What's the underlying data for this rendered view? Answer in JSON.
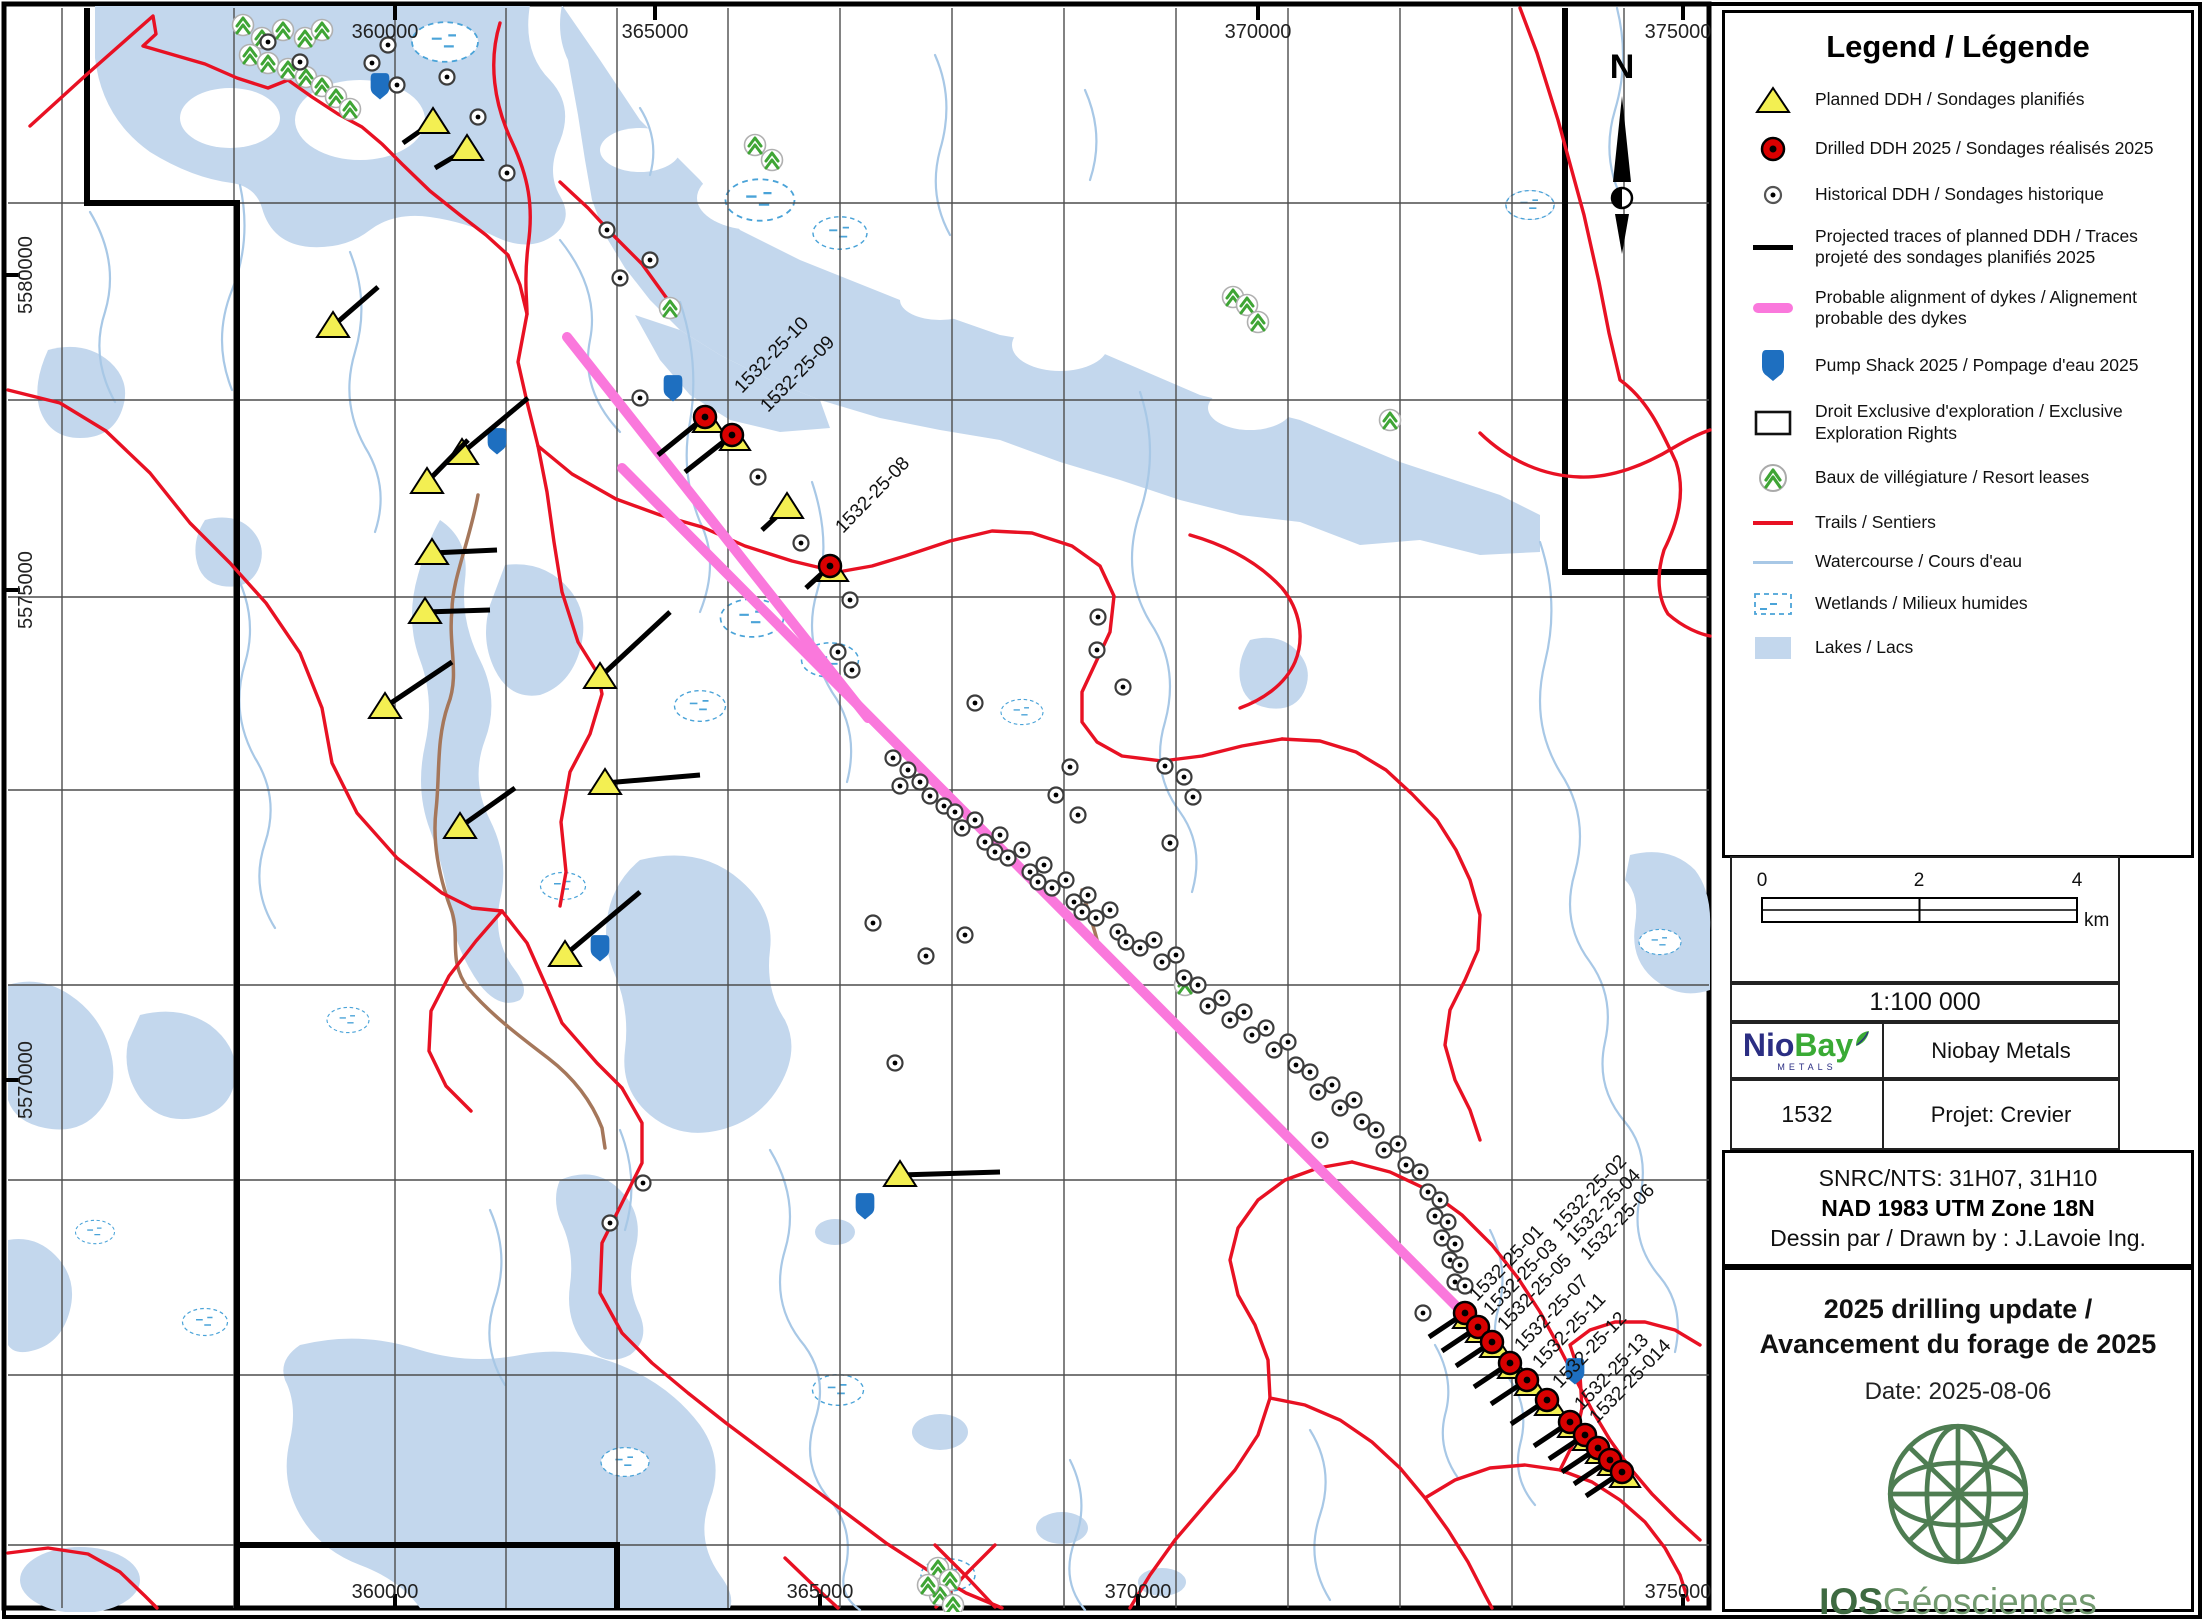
{
  "legend": {
    "title": "Legend / Légende",
    "items": [
      "Planned DDH / Sondages planifiés",
      "Drilled DDH 2025 / Sondages réalisés 2025",
      "Historical DDH / Sondages historique",
      "Projected traces of planned DDH / Traces projeté des sondages planifiés 2025",
      "Probable alignment of dykes / Alignement probable des dykes",
      "Pump Shack 2025 / Pompage d'eau 2025",
      "Droit Exclusive d'exploration / Exclusive Exploration Rights",
      "Baux de villégiature / Resort leases",
      "Trails / Sentiers",
      "Watercourse / Cours d'eau",
      "Wetlands / Milieux humides",
      "Lakes / Lacs"
    ]
  },
  "scalebar": {
    "t0": "0",
    "t2": "2",
    "t4": "4",
    "unit": "km",
    "ratio": "1:100 000"
  },
  "titleblock": {
    "logo_nio": "Nio",
    "logo_bay": "Bay",
    "logo_metals": "METALS",
    "company": "Niobay Metals",
    "code": "1532",
    "project": "Projet: Crevier",
    "snrc": "SNRC/NTS: 31H07, 31H10",
    "datum": "NAD 1983 UTM Zone 18N",
    "drawn": "Dessin par / Drawn by : J.Lavoie Ing.",
    "title1": "2025 drilling update /",
    "title2": "Avancement du forage de 2025",
    "date": "Date: 2025-08-06",
    "ios_bold": "IOS",
    "ios_rest": "Géosciences"
  },
  "colors": {
    "lake": "#c3d7ed",
    "watercourse": "#a8c8e6",
    "wetland": "#4aa3d8",
    "trail": "#e81123",
    "dyke_pink": "#fa78dc",
    "planned_yellow": "#f3ef52",
    "drilled_red": "#d90000",
    "pump_blue": "#1e6fc0",
    "tree_green": "#3fa535",
    "road_brown": "#a5775b"
  },
  "map": {
    "north_label": "N",
    "axis_top": [
      "360000",
      "365000",
      "370000",
      "375000"
    ],
    "axis_bottom": [
      "360000",
      "365000",
      "370000",
      "375000"
    ],
    "axis_left": [
      "5580000",
      "5575000",
      "5570000"
    ],
    "ddh_top": [
      {
        "t": "1532-25-10",
        "x": 705,
        "y": 417,
        "ex": 658,
        "ey": 455,
        "lx": 742,
        "ly": 394
      },
      {
        "t": "1532-25-09",
        "x": 732,
        "y": 435,
        "ex": 685,
        "ey": 472,
        "lx": 768,
        "ly": 413
      },
      {
        "t": "1532-25-08",
        "x": 830,
        "y": 566,
        "ex": 806,
        "ey": 588,
        "lx": 843,
        "ly": 534
      }
    ],
    "ddh_bottom_markers": [
      [
        1465,
        1313
      ],
      [
        1478,
        1327
      ],
      [
        1492,
        1342
      ],
      [
        1510,
        1363
      ],
      [
        1527,
        1380
      ],
      [
        1547,
        1400
      ],
      [
        1570,
        1422
      ],
      [
        1585,
        1435
      ],
      [
        1598,
        1448
      ],
      [
        1610,
        1460
      ],
      [
        1622,
        1472
      ]
    ],
    "ddh_bottom_labels": [
      {
        "t": "1532-25-01",
        "x": 1477,
        "y": 1302
      },
      {
        "t": "1532-25-02",
        "x": 1560,
        "y": 1232
      },
      {
        "t": "1532-25-03",
        "x": 1491,
        "y": 1316
      },
      {
        "t": "1532-25-04",
        "x": 1574,
        "y": 1246
      },
      {
        "t": "1532-25-05",
        "x": 1505,
        "y": 1331
      },
      {
        "t": "1532-25-06",
        "x": 1588,
        "y": 1261
      },
      {
        "t": "1532-25-07",
        "x": 1522,
        "y": 1352
      },
      {
        "t": "1532-25-11",
        "x": 1540,
        "y": 1369
      },
      {
        "t": "1532-25-12",
        "x": 1560,
        "y": 1389
      },
      {
        "t": "1532-25-13",
        "x": 1582,
        "y": 1411
      },
      {
        "t": "1532-25-014",
        "x": 1597,
        "y": 1424
      }
    ],
    "planned": [
      {
        "x": 433,
        "y": 122,
        "ex": 403,
        "ey": 143
      },
      {
        "x": 467,
        "y": 149,
        "ex": 435,
        "ey": 168
      },
      {
        "x": 333,
        "y": 326,
        "ex": 378,
        "ey": 287
      },
      {
        "x": 462,
        "y": 453,
        "ex": 528,
        "ey": 398
      },
      {
        "x": 427,
        "y": 482,
        "ex": 468,
        "ey": 440
      },
      {
        "x": 432,
        "y": 553,
        "ex": 497,
        "ey": 550
      },
      {
        "x": 425,
        "y": 612,
        "ex": 490,
        "ey": 610
      },
      {
        "x": 385,
        "y": 707,
        "ex": 452,
        "ey": 662
      },
      {
        "x": 600,
        "y": 677,
        "ex": 670,
        "ey": 612
      },
      {
        "x": 605,
        "y": 783,
        "ex": 700,
        "ey": 775
      },
      {
        "x": 460,
        "y": 827,
        "ex": 515,
        "ey": 788
      },
      {
        "x": 565,
        "y": 955,
        "ex": 640,
        "ey": 892
      },
      {
        "x": 900,
        "y": 1175,
        "ex": 1000,
        "ey": 1172
      },
      {
        "x": 787,
        "y": 507,
        "ex": 762,
        "ey": 530
      }
    ],
    "pumps": [
      [
        380,
        85
      ],
      [
        497,
        440
      ],
      [
        673,
        387
      ],
      [
        600,
        947
      ],
      [
        865,
        1205
      ],
      [
        1575,
        1370
      ]
    ],
    "trees": [
      [
        243,
        25
      ],
      [
        262,
        38
      ],
      [
        283,
        30
      ],
      [
        305,
        38
      ],
      [
        322,
        30
      ],
      [
        250,
        55
      ],
      [
        268,
        63
      ],
      [
        288,
        69
      ],
      [
        306,
        77
      ],
      [
        322,
        86
      ],
      [
        336,
        97
      ],
      [
        350,
        109
      ],
      [
        755,
        145
      ],
      [
        772,
        160
      ],
      [
        1233,
        297
      ],
      [
        1247,
        305
      ],
      [
        1258,
        322
      ],
      [
        670,
        308
      ],
      [
        1185,
        985
      ],
      [
        1390,
        420
      ],
      [
        938,
        1568
      ],
      [
        950,
        1580
      ],
      [
        940,
        1595
      ],
      [
        953,
        1605
      ],
      [
        928,
        1585
      ]
    ],
    "historical": [
      [
        893,
        758
      ],
      [
        908,
        770
      ],
      [
        900,
        786
      ],
      [
        920,
        782
      ],
      [
        930,
        796
      ],
      [
        944,
        806
      ],
      [
        955,
        812
      ],
      [
        962,
        828
      ],
      [
        975,
        820
      ],
      [
        985,
        842
      ],
      [
        1000,
        835
      ],
      [
        995,
        852
      ],
      [
        1008,
        858
      ],
      [
        1022,
        850
      ],
      [
        1030,
        872
      ],
      [
        1044,
        865
      ],
      [
        1038,
        882
      ],
      [
        1052,
        888
      ],
      [
        1066,
        880
      ],
      [
        1074,
        902
      ],
      [
        1088,
        895
      ],
      [
        1082,
        912
      ],
      [
        1096,
        918
      ],
      [
        1110,
        910
      ],
      [
        1118,
        932
      ],
      [
        1126,
        942
      ],
      [
        1140,
        948
      ],
      [
        1154,
        940
      ],
      [
        1162,
        962
      ],
      [
        1176,
        955
      ],
      [
        1184,
        978
      ],
      [
        1198,
        985
      ],
      [
        1208,
        1006
      ],
      [
        1222,
        998
      ],
      [
        1230,
        1020
      ],
      [
        1244,
        1012
      ],
      [
        1252,
        1035
      ],
      [
        1266,
        1028
      ],
      [
        1274,
        1050
      ],
      [
        1288,
        1042
      ],
      [
        1296,
        1065
      ],
      [
        1310,
        1072
      ],
      [
        1318,
        1092
      ],
      [
        1332,
        1085
      ],
      [
        1340,
        1108
      ],
      [
        1354,
        1100
      ],
      [
        1362,
        1122
      ],
      [
        1376,
        1130
      ],
      [
        1384,
        1150
      ],
      [
        1398,
        1144
      ],
      [
        1406,
        1165
      ],
      [
        1420,
        1172
      ],
      [
        1428,
        1192
      ],
      [
        1440,
        1200
      ],
      [
        1435,
        1216
      ],
      [
        1448,
        1222
      ],
      [
        1442,
        1238
      ],
      [
        1455,
        1244
      ],
      [
        1450,
        1260
      ],
      [
        1460,
        1265
      ],
      [
        1455,
        1282
      ],
      [
        1465,
        1286
      ],
      [
        388,
        45
      ],
      [
        372,
        63
      ],
      [
        397,
        85
      ],
      [
        447,
        77
      ],
      [
        478,
        117
      ],
      [
        507,
        173
      ],
      [
        607,
        230
      ],
      [
        650,
        260
      ],
      [
        620,
        278
      ],
      [
        640,
        398
      ],
      [
        758,
        477
      ],
      [
        801,
        543
      ],
      [
        850,
        600
      ],
      [
        838,
        652
      ],
      [
        852,
        670
      ],
      [
        975,
        703
      ],
      [
        1097,
        650
      ],
      [
        1123,
        687
      ],
      [
        873,
        923
      ],
      [
        965,
        935
      ],
      [
        926,
        956
      ],
      [
        895,
        1063
      ],
      [
        1070,
        767
      ],
      [
        1165,
        766
      ],
      [
        1184,
        777
      ],
      [
        1193,
        797
      ],
      [
        1056,
        795
      ],
      [
        1078,
        815
      ],
      [
        643,
        1183
      ],
      [
        610,
        1223
      ],
      [
        1423,
        1313
      ],
      [
        1098,
        617
      ],
      [
        1170,
        843
      ],
      [
        1320,
        1140
      ],
      [
        268,
        42
      ],
      [
        300,
        62
      ]
    ]
  }
}
